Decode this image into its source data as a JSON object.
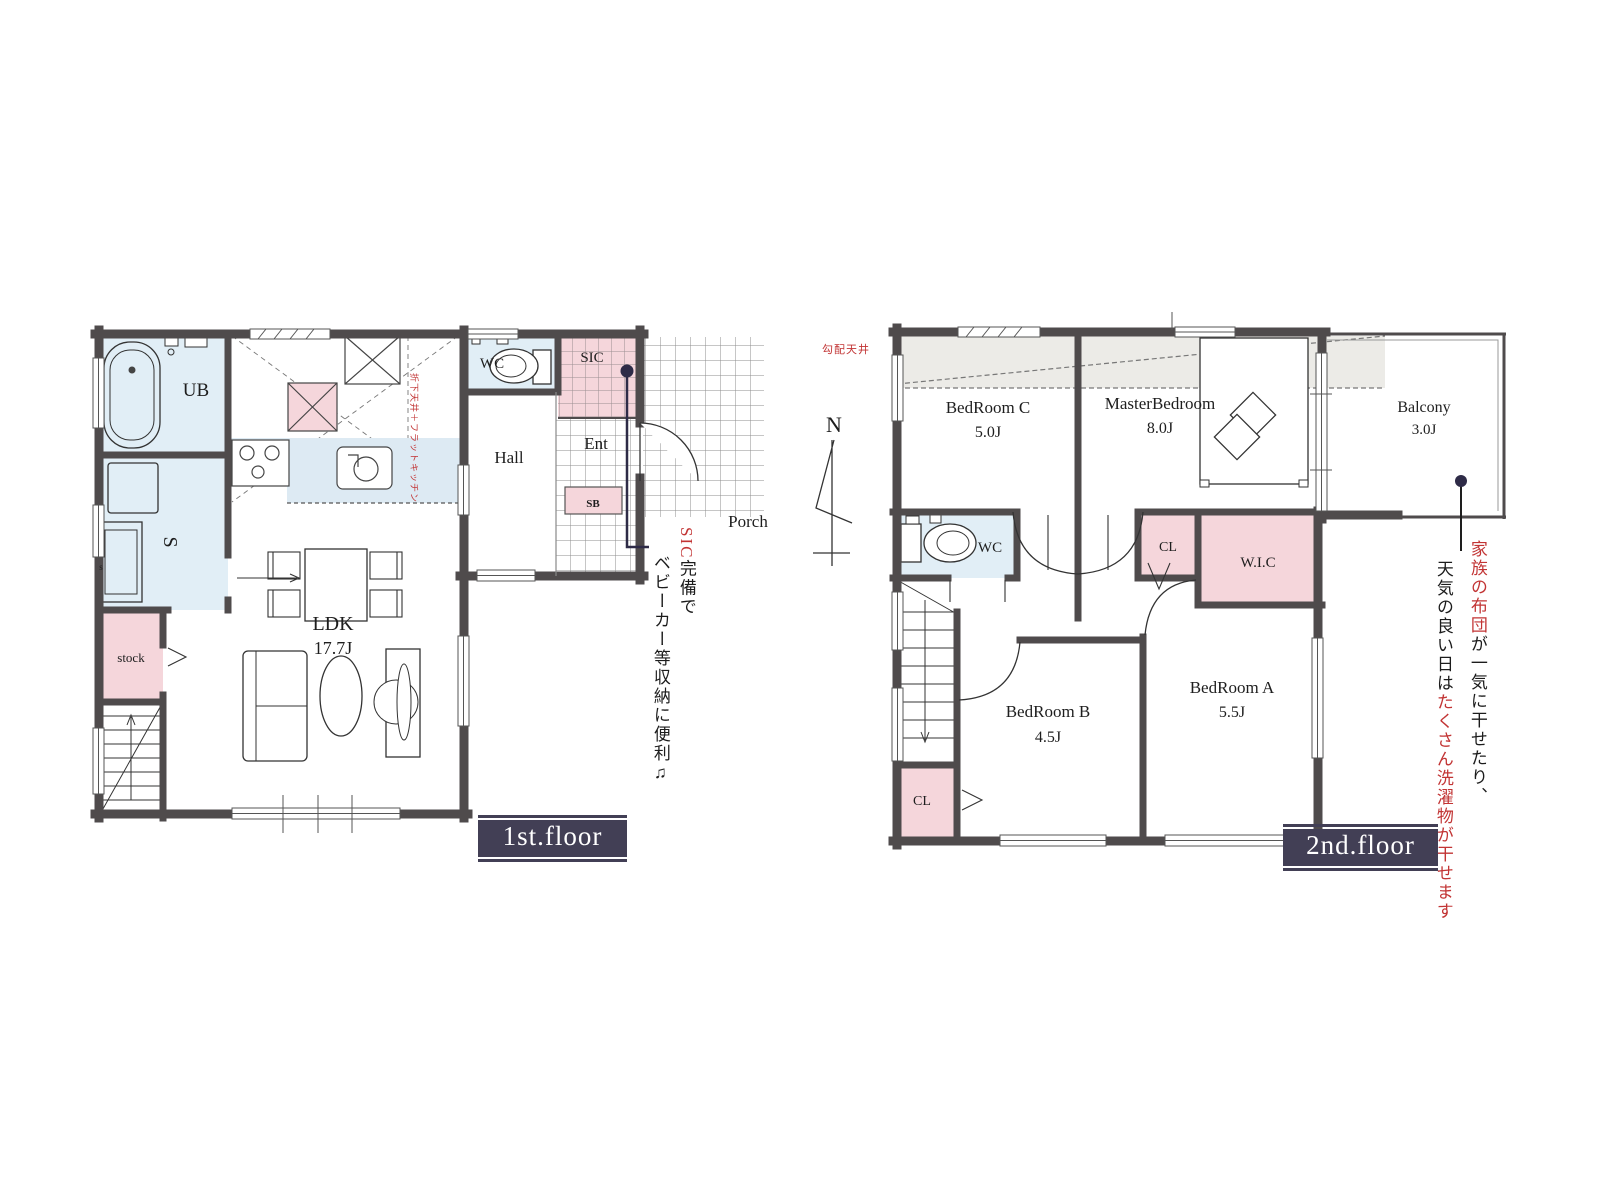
{
  "floor1": {
    "label": "1st.floor",
    "rooms": {
      "ub": "UB",
      "s": "S",
      "s_window_tag": "s",
      "stock": "stock",
      "ldk_name": "LDK",
      "ldk_size": "17.7J",
      "wc": "WC",
      "hall": "Hall",
      "ent": "Ent",
      "sic": "SIC",
      "sb": "SB",
      "porch": "Porch"
    },
    "notes": {
      "kitchen_ceiling": "折下天井＋フラットキッチン",
      "sic_highlight": "SIC",
      "sic_rest": "完備で",
      "sic_line2": "ベビーカー等収納に便利♫"
    }
  },
  "floor2": {
    "label": "2nd.floor",
    "compass_n": "N",
    "rooms": {
      "bedroom_c": "BedRoom C",
      "bedroom_c_size": "5.0J",
      "master": "MasterBedroom",
      "master_size": "8.0J",
      "balcony": "Balcony",
      "balcony_size": "3.0J",
      "wc": "WC",
      "cl_upper": "CL",
      "wic": "W.I.C",
      "bedroom_b": "BedRoom B",
      "bedroom_b_size": "4.5J",
      "bedroom_a": "BedRoom A",
      "bedroom_a_size": "5.5J",
      "cl_lower": "CL"
    },
    "notes": {
      "sloped_ceiling": "勾配天井",
      "balcony_col1_red": "家族の布団",
      "balcony_col1_black": "が一気に干せたり、",
      "balcony_col2_black": "天気の良い日は",
      "balcony_col2_red": "たくさん洗濯物が干せます"
    }
  },
  "colors": {
    "wall": "#4f4b4c",
    "room_blue": "#e1eef6",
    "room_pink": "#f5d6db",
    "sloped_gray": "#ecebe7",
    "floor_label_bg": "#423f55",
    "accent_red": "#c23434",
    "leader_navy": "#2e2b47"
  },
  "icons": [
    "bathtub-icon",
    "washing-machine-icon",
    "toilet-icon",
    "stove-icon",
    "kitchen-sink-icon",
    "dining-table-icon",
    "chair-icon",
    "sofa-icon",
    "coffee-table-icon",
    "tv-board-icon",
    "stairs-icon",
    "bed-icon",
    "pillow-icon",
    "compass-north-icon",
    "door-arc-icon",
    "tile-grid-icon"
  ]
}
